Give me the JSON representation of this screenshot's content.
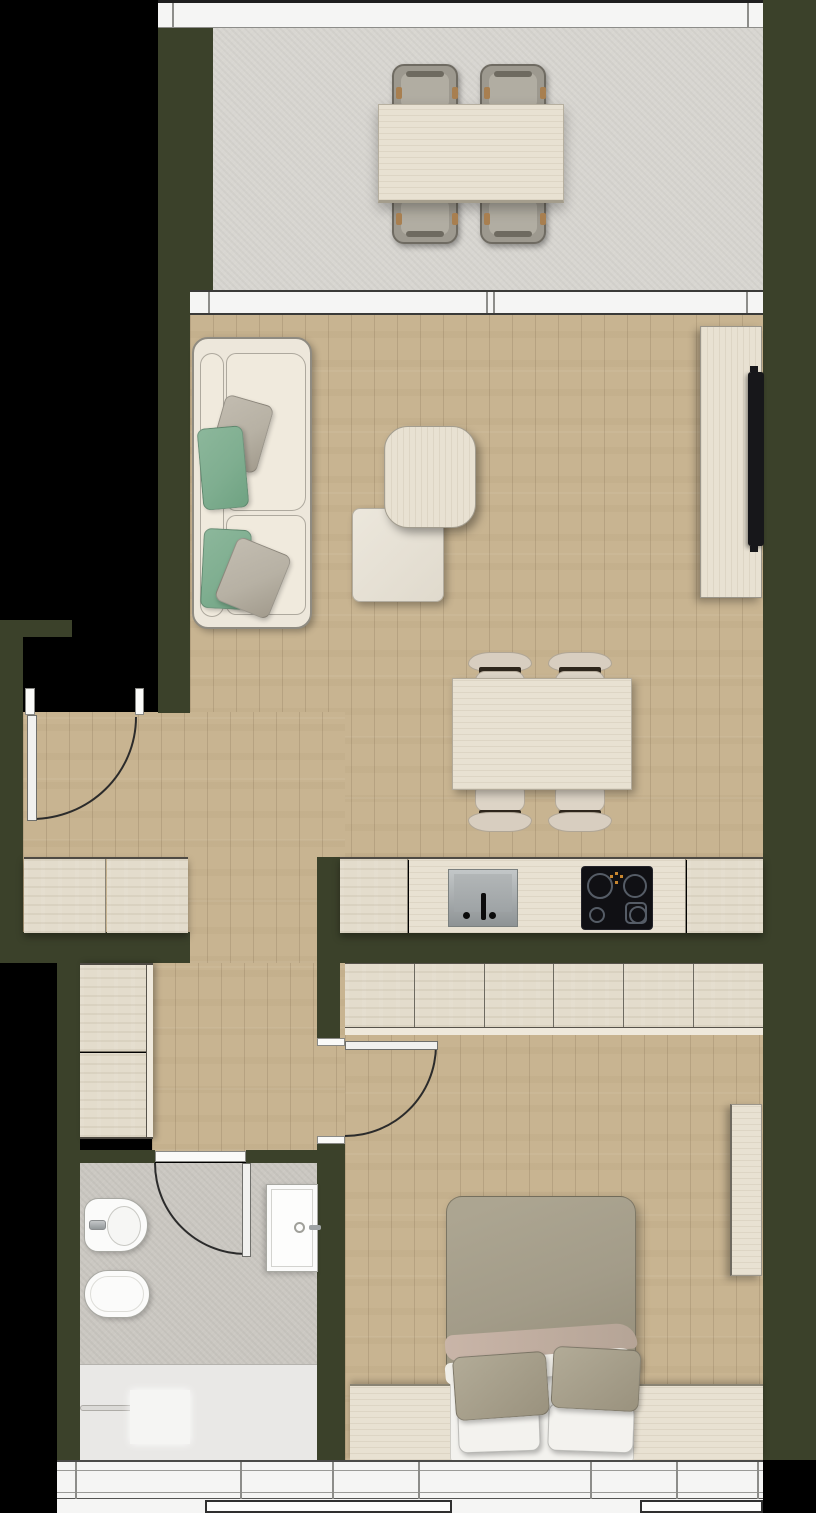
{
  "palette": {
    "outside": "#000000",
    "wall": "#3b412a",
    "wood-floor": "#c8b491",
    "balcony-floor": "#d8d6d1",
    "bath-floor": "#cbc8c2",
    "cabinet-front": "#e3dccc",
    "furniture-wood": "#e8e1d2",
    "sofa": "#ede7db",
    "sofa-edge": "#8f8b81",
    "pillow-green": "#7fae90",
    "pillow-gray": "#b7b1a4",
    "chair-beige": "#d8cec0",
    "chair-bar": "#2e261c",
    "balcony-chair": "#9d998f",
    "balcony-chair-cushion": "#b1ada2",
    "duvet": "#a39c89",
    "duvet-fold": "#c9b5a8",
    "linen-white": "#f3f2ee",
    "fixture-white": "#fbfbfa",
    "fixture-edge": "#a8a8a2",
    "shower-floor": "#e9e8e6",
    "appliance-black": "#101014",
    "tv-black": "#17171a",
    "glass-band": "#f5f5f4",
    "frame-dark": "#2b2b2b",
    "frame-mid": "#8d8d8a"
  },
  "plan": {
    "type": "apartment-floor-plan-top-view",
    "rooms": [
      {
        "name": "balcony",
        "floor": "concrete",
        "furniture": [
          "outdoor-dining-table",
          "outdoor-chair",
          "outdoor-chair",
          "outdoor-chair",
          "outdoor-chair"
        ]
      },
      {
        "name": "living-room",
        "floor": "wood",
        "furniture": [
          "sofa",
          "green-pillow",
          "green-pillow",
          "gray-pillow",
          "gray-pillow",
          "wood-coffee-table",
          "ottoman",
          "dining-table",
          "dining-chair",
          "dining-chair",
          "dining-chair",
          "dining-chair",
          "tv-sideboard",
          "tv"
        ]
      },
      {
        "name": "kitchen",
        "floor": "wood",
        "furniture": [
          "counter-cabinet",
          "sink",
          "faucet",
          "induction-cooktop",
          "counter-cabinet"
        ]
      },
      {
        "name": "hallway",
        "floor": "wood",
        "furniture": [
          "entry-door",
          "sideboard",
          "wardrobe"
        ]
      },
      {
        "name": "bedroom",
        "floor": "wood",
        "furniture": [
          "six-door-wardrobe",
          "interior-door",
          "double-bed",
          "olive-pillow",
          "olive-pillow",
          "white-pillow",
          "white-pillow",
          "headboard-bench",
          "wall-desk"
        ]
      },
      {
        "name": "bathroom",
        "floor": "concrete",
        "furniture": [
          "interior-door",
          "bidet",
          "wall-hung-toilet",
          "washbasin",
          "shower-area",
          "shower-handle"
        ]
      }
    ],
    "window_walls": [
      "balcony-top-glazing",
      "living-balcony-glazing",
      "bottom-window-band"
    ]
  }
}
